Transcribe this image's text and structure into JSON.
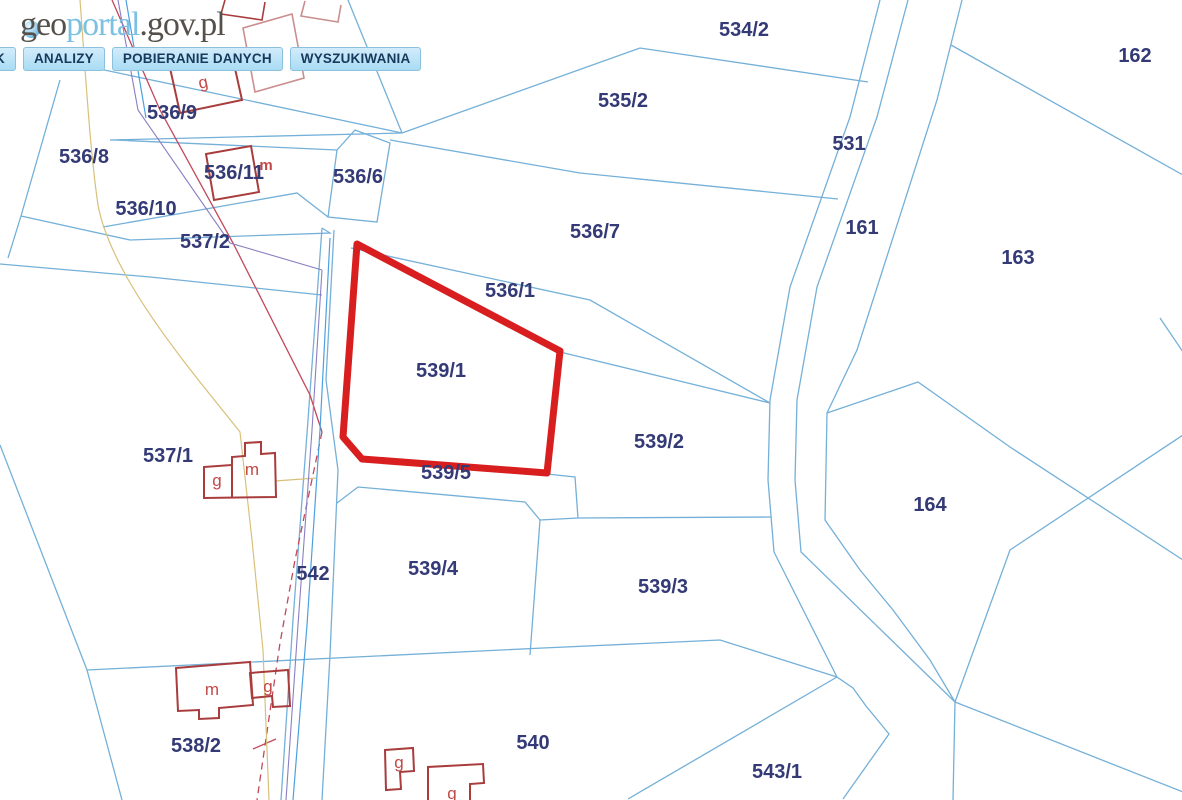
{
  "logo": {
    "prefix": "geo",
    "mid": "portal",
    "suffix": ".gov.pl"
  },
  "menu": {
    "items": [
      "K",
      "ANALIZY",
      "POBIERANIE DANYCH",
      "WYSZUKIWANIA"
    ]
  },
  "map": {
    "selected_parcel": "539/1",
    "parcel_labels": [
      "534/2",
      "162",
      "535/2",
      "536/9",
      "531",
      "536/8",
      "536/11",
      "536/6",
      "536/10",
      "161",
      "536/7",
      "537/2",
      "163",
      "536/1",
      "539/1",
      "537/1",
      "539/2",
      "539/5",
      "164",
      "539/4",
      "542",
      "539/3",
      "540",
      "538/2",
      "543/1"
    ],
    "building_labels": [
      "g",
      "m",
      "g",
      "m",
      "m",
      "g",
      "g",
      "g"
    ],
    "colors": {
      "parcel_boundary": "#74b0d8",
      "parcel_label": "#333a75",
      "selection_outline": "#d81e1e",
      "building_outline": "#a93c3c",
      "building_outline_light": "#c98e8e",
      "building_label": "#c24848",
      "utility_power_red": "#c3485a",
      "utility_tan": "#d8c07a",
      "utility_purple": "#8a7ec2",
      "utility_blue": "#4aa0e0",
      "menu_button_bg": "#a9dcf4",
      "menu_button_text": "#17395c",
      "logo_dark": "#55504a",
      "logo_blue": "#7cc0e2",
      "background": "#ffffff"
    }
  }
}
